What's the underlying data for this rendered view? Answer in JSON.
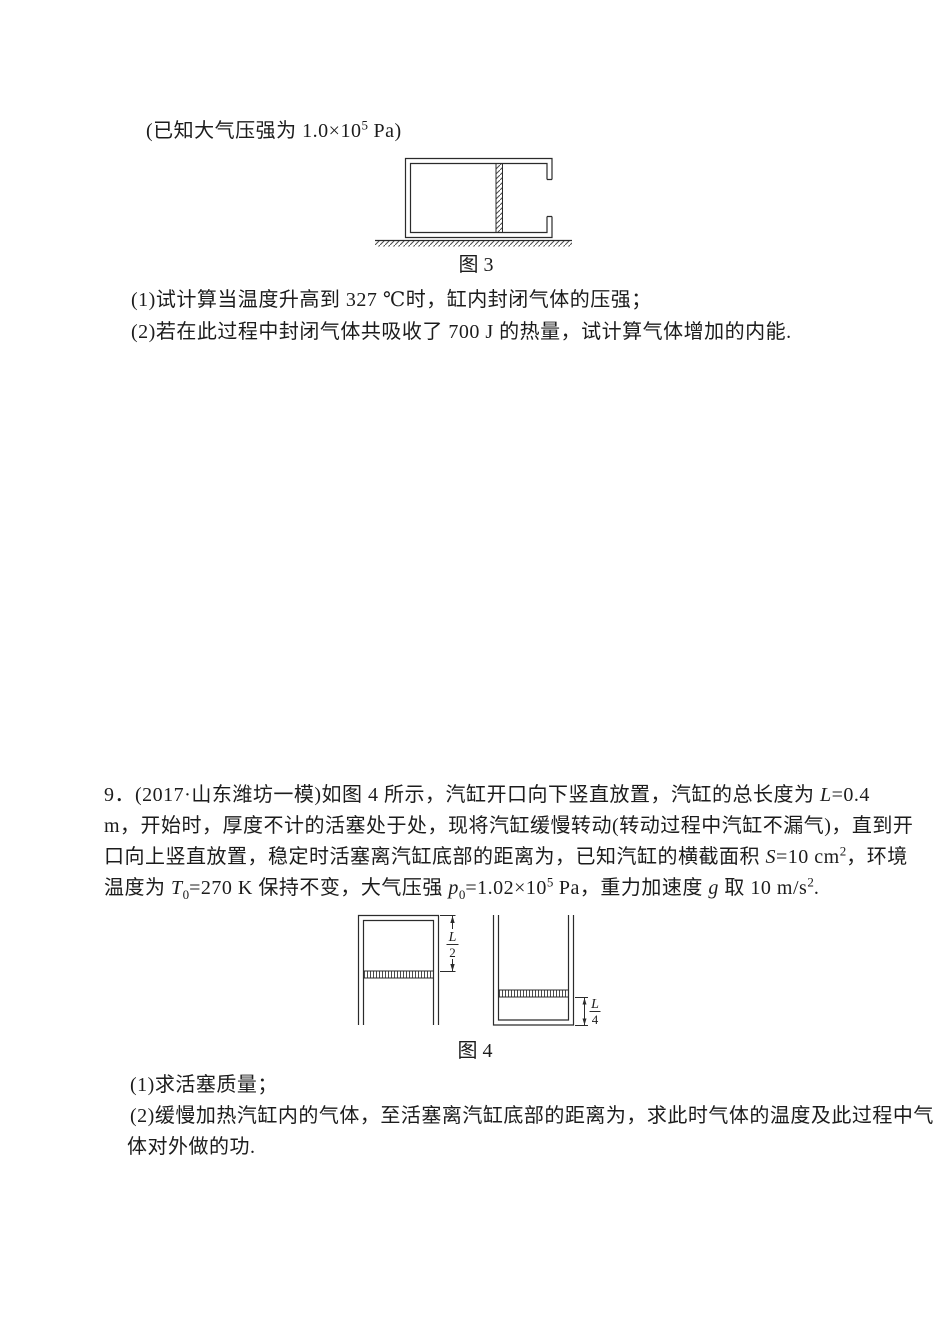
{
  "intro": {
    "line": [
      {
        "t": "(已知大气压强为 1.0×10"
      },
      {
        "t": "5",
        "s": "sup"
      },
      {
        "t": " Pa)"
      }
    ]
  },
  "figure3": {
    "caption": "图 3"
  },
  "problem8": {
    "q1": [
      {
        "t": "(1)试计算当温度升高到 327 ℃时，缸内封闭气体的压强；"
      }
    ],
    "q2": [
      {
        "t": "(2)若在此过程中封闭气体共吸收了 700 J 的热量，试计算气体增加的内能."
      }
    ]
  },
  "problem9": {
    "lines": [
      [
        {
          "t": "9．(2017·山东潍坊一模)如图 4 所示，汽缸开口向下竖直放置，汽缸的总长度为 "
        },
        {
          "t": "L",
          "s": "i"
        },
        {
          "t": "=0.4"
        }
      ],
      [
        {
          "t": "m，开始时，厚度不计的活塞处于处，现将汽缸缓慢转动(转动过程中汽缸不漏气)，直到开"
        }
      ],
      [
        {
          "t": "口向上竖直放置，稳定时活塞离汽缸底部的距离为，已知汽缸的横截面积 "
        },
        {
          "t": "S",
          "s": "i"
        },
        {
          "t": "=10 cm"
        },
        {
          "t": "2",
          "s": "sup"
        },
        {
          "t": "，环境"
        }
      ],
      [
        {
          "t": "温度为 "
        },
        {
          "t": "T",
          "s": "i"
        },
        {
          "t": "0",
          "s": "sub"
        },
        {
          "t": "=270 K 保持不变，大气压强 "
        },
        {
          "t": "p",
          "s": "i"
        },
        {
          "t": "0",
          "s": "sub"
        },
        {
          "t": "=1.02×10"
        },
        {
          "t": "5",
          "s": "sup"
        },
        {
          "t": " Pa，重力加速度 "
        },
        {
          "t": "g",
          "s": "i"
        },
        {
          "t": " 取 10 m/s"
        },
        {
          "t": "2",
          "s": "sup"
        },
        {
          "t": "."
        }
      ]
    ],
    "q1": [
      {
        "t": "(1)求活塞质量；"
      }
    ],
    "q2a": [
      {
        "t": "(2)缓慢加热汽缸内的气体，至活塞离汽缸底部的距离为，求此时气体的温度及此过程中气"
      }
    ],
    "q2b": [
      {
        "t": "体对外做的功."
      }
    ]
  },
  "figure4": {
    "caption": "图 4",
    "dim_left_num": "L",
    "dim_left_den": "2",
    "dim_right_num": "L",
    "dim_right_den": "4"
  }
}
